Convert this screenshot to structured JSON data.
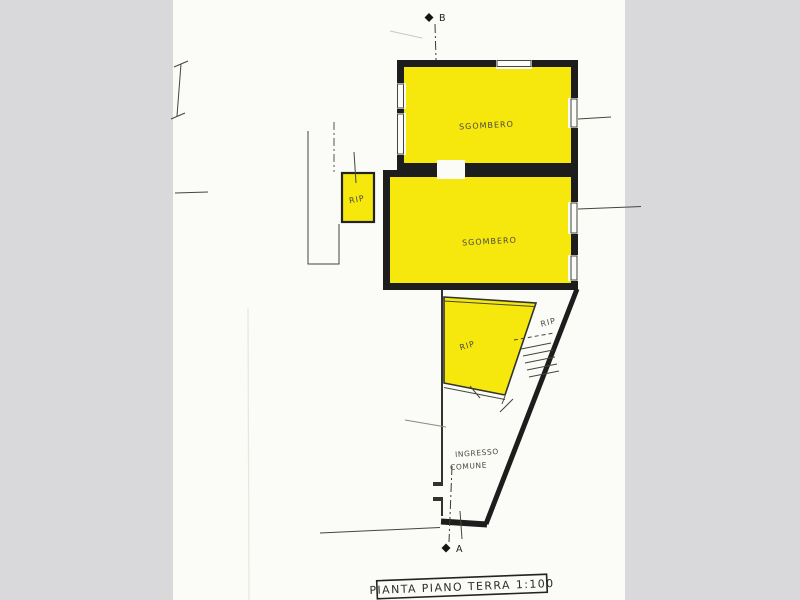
{
  "document": {
    "kind": "scanned architectural floor plan",
    "title_box": {
      "label": "PIANTA PIANO TERRA  1:100"
    },
    "section_markers": {
      "top_label": "B",
      "bottom_label": "A"
    },
    "rooms": {
      "sgombero_upper": "SGOMBERO",
      "sgombero_middle": "SGOMBERO",
      "rip_small": "RIP",
      "rip_lower": "RIP",
      "rip_stair": "RIP"
    },
    "entrance": {
      "line1": "INGRESSO",
      "line2": "COMUNE"
    },
    "colors": {
      "highlight_yellow": "#f6e70d",
      "wall_ink": "#1d1d1d",
      "pencil_line": "#46463f",
      "paper": "#fbfbf7",
      "backdrop": "#d9d9db"
    }
  }
}
